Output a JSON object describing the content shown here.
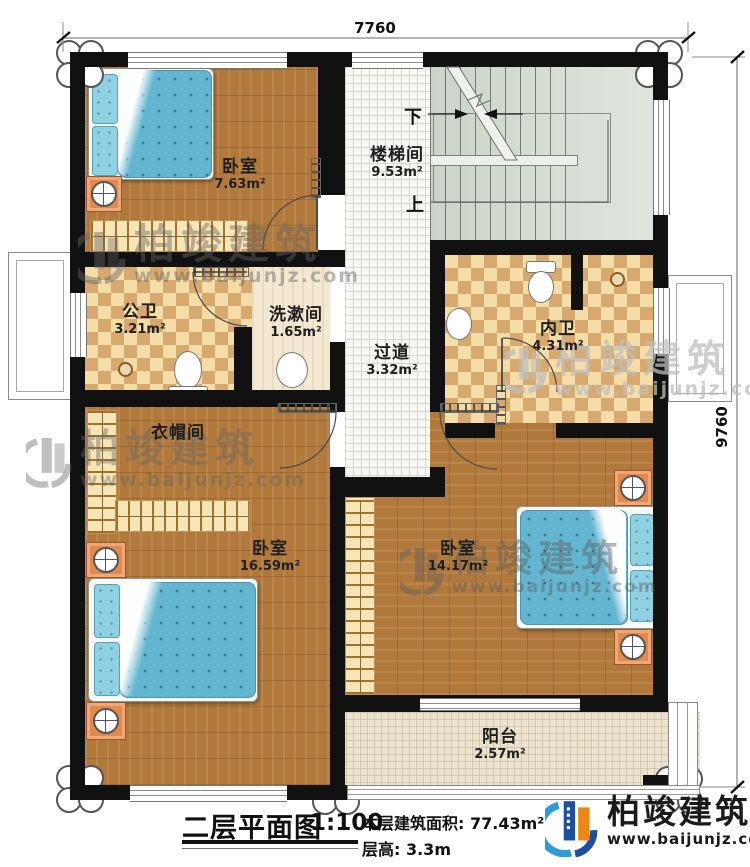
{
  "plan": {
    "title": "二层平面图",
    "scale": "1:100",
    "floor_area": "本层建筑面积: 77.43m²",
    "floor_height": "层高: 3.3m",
    "dim_top": "7760",
    "dim_right": "9760",
    "stair_down": "下",
    "stair_up": "上"
  },
  "rooms": [
    {
      "name": "卧室",
      "area": "7.63m²"
    },
    {
      "name": "楼梯间",
      "area": "9.53m²"
    },
    {
      "name": "公卫",
      "area": "3.21m²"
    },
    {
      "name": "洗漱间",
      "area": "1.65m²"
    },
    {
      "name": "过道",
      "area": "3.32m²"
    },
    {
      "name": "内卫",
      "area": "4.31m²"
    },
    {
      "name": "衣帽间",
      "area": ""
    },
    {
      "name": "卧室",
      "area": "16.59m²"
    },
    {
      "name": "卧室",
      "area": "14.17m²"
    },
    {
      "name": "阳台",
      "area": "2.57m²"
    }
  ],
  "brand": {
    "name": "柏竣建筑",
    "website": "www.baijunjz.com"
  },
  "colors": {
    "wall": "#111111",
    "wood_floor": "#b2793c",
    "bath_tile_light": "#f4dda6",
    "bath_tile_dark": "#d7a96e",
    "stair_floor": "#d8dfd5",
    "bed_blue": "#63b5d0",
    "balcony_floor": "#ebe3cf",
    "logo_blue": "#1d4fa0",
    "logo_light_blue": "#2e9bd8",
    "logo_orange": "#f08419"
  }
}
